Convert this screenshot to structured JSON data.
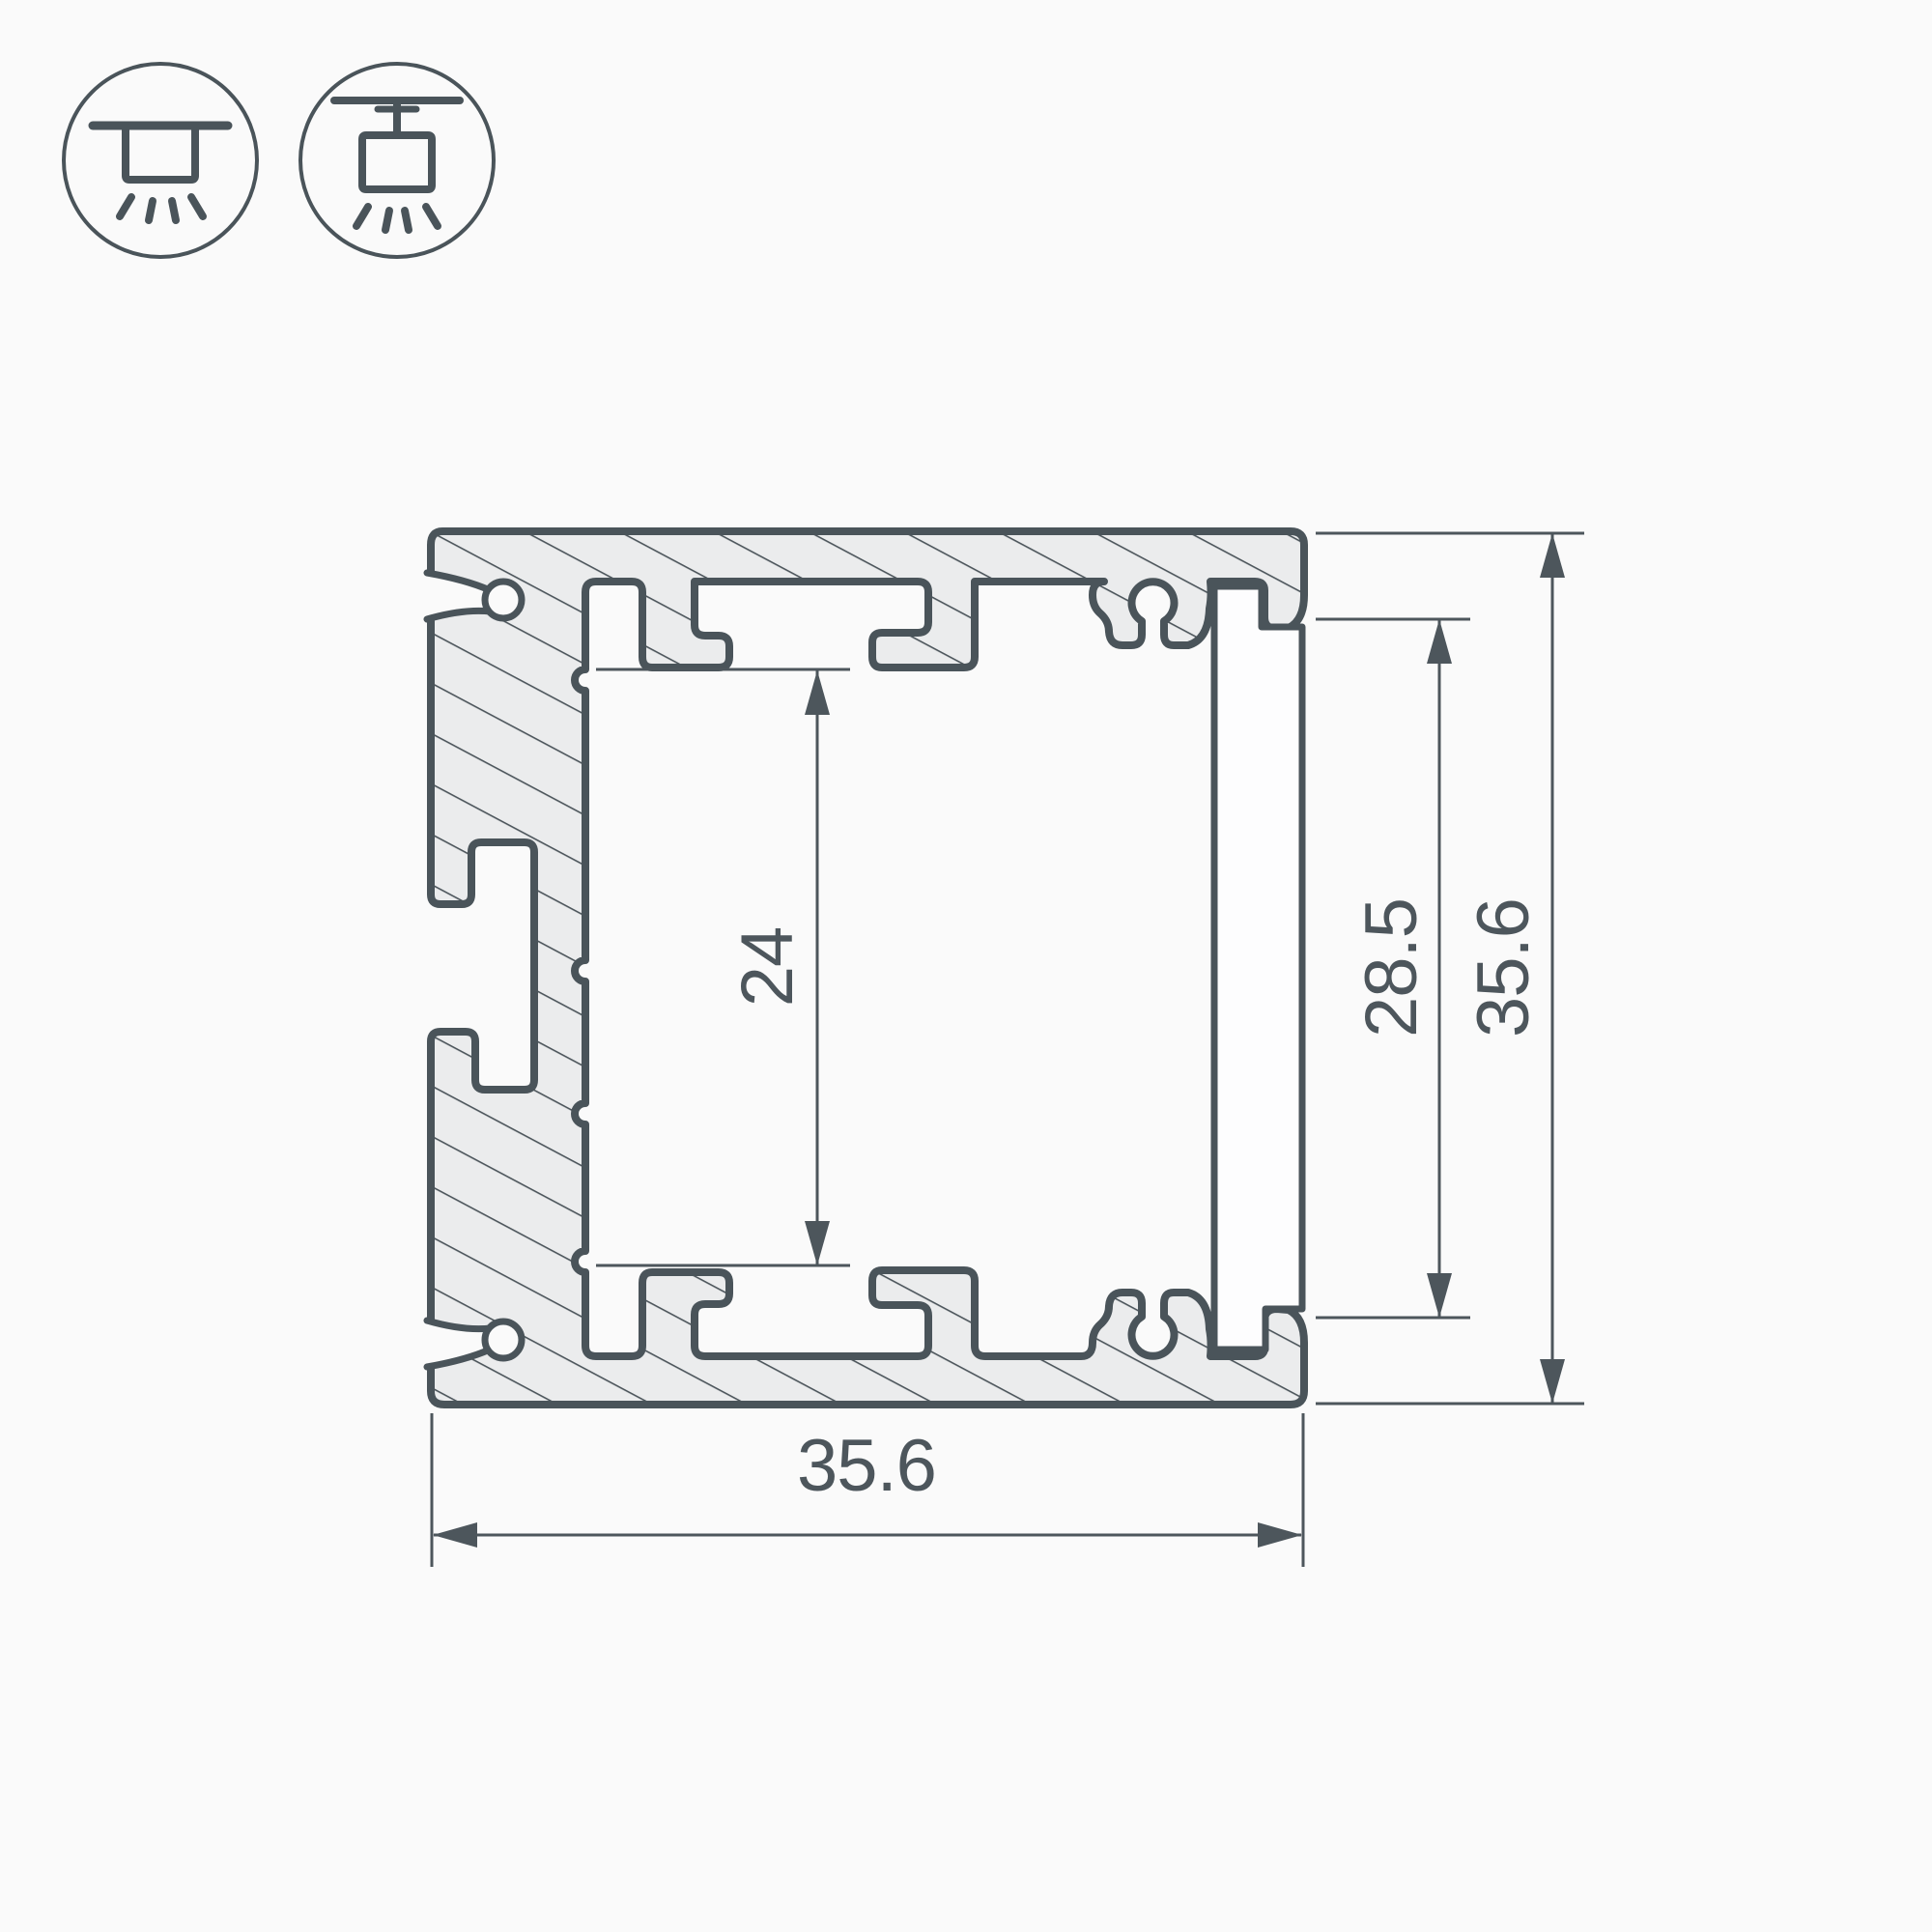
{
  "drawing": {
    "title": "led-profile-cross-section",
    "dimensions": {
      "overall_width": {
        "value": "35.6"
      },
      "overall_height": {
        "value": "35.6"
      },
      "window_height": {
        "value": "28.5"
      },
      "inner_height": {
        "value": "24"
      }
    },
    "icons": [
      {
        "name": "surface-mount-icon"
      },
      {
        "name": "pendant-mount-icon"
      }
    ],
    "colors": {
      "background": "#fafafa",
      "line": "#4a545a",
      "metal_fill": "#ebeced",
      "text": "#4d565c"
    }
  }
}
